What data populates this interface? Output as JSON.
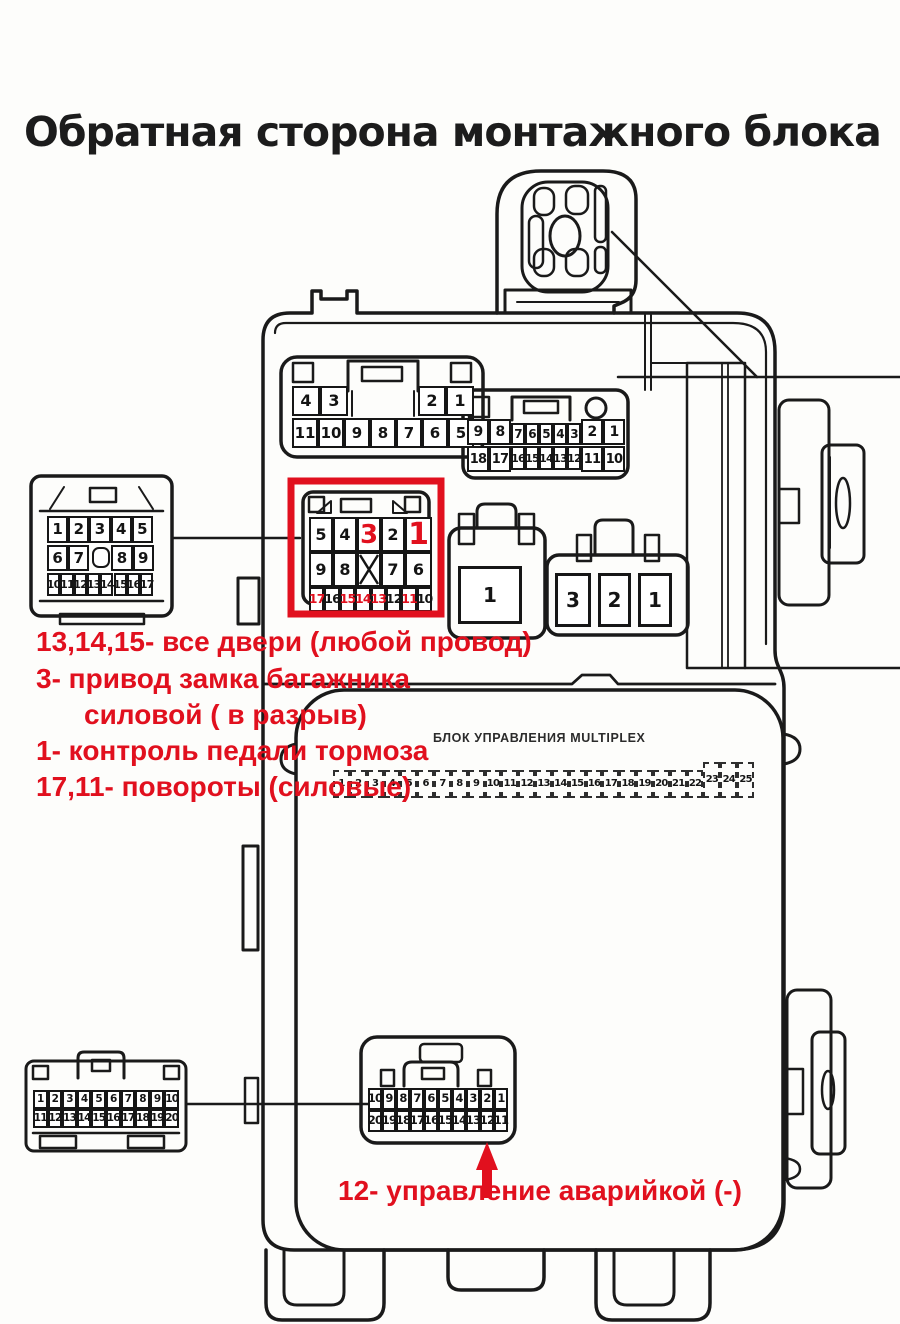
{
  "title": "Обратная сторона монтажного блока",
  "colors": {
    "red": "#e1101e",
    "ink": "#1a1a1a",
    "paper": "#fdfdfb"
  },
  "annotations": {
    "doors": "13,14,15- все двери (любой провод)",
    "trunk1": "3- привод замка багажника",
    "trunk2": "силовой ( в разрыв)",
    "brake": "1- контроль педали тормоза",
    "turn": "17,11- повороты (силовые)",
    "hazard": "12- управление аварийкой (-)"
  },
  "multiplex_panel": {
    "label": "БЛОК УПРАВЛЕНИЯ MULTIPLEX",
    "strip": [
      "1",
      "2",
      "3",
      "4",
      "5",
      "6",
      "7",
      "8",
      "9",
      "10",
      "11",
      "12",
      "13",
      "14",
      "15",
      "16",
      "17",
      "18",
      "19",
      "20",
      "21",
      "22",
      "23",
      "24",
      "25"
    ]
  },
  "connectors": {
    "left17": {
      "row1": [
        "1",
        "2",
        "3",
        "4",
        "5"
      ],
      "row2": [
        "6",
        "7",
        "8",
        "9"
      ],
      "row3": [
        "10",
        "11",
        "12",
        "13",
        "14",
        "15",
        "16",
        "17"
      ]
    },
    "topA": {
      "row1": [
        "4",
        "3",
        "2",
        "1"
      ],
      "row2": [
        "11",
        "10",
        "9",
        "8",
        "7",
        "6",
        "5"
      ]
    },
    "topB": {
      "row1": [
        "9",
        "8",
        "7",
        "6",
        "5",
        "4",
        "3",
        "2",
        "1"
      ],
      "row2": [
        "18",
        "17",
        "16",
        "15",
        "14",
        "13",
        "12",
        "11",
        "10"
      ]
    },
    "highlight": {
      "row1": [
        "5",
        "4",
        "3",
        "2",
        "1"
      ],
      "row1_red": [
        "3",
        "1"
      ],
      "row2": [
        "9",
        "8",
        "X",
        "7",
        "6"
      ],
      "row3": [
        "17",
        "16",
        "15",
        "14",
        "13",
        "12",
        "11",
        "10"
      ],
      "row3_red": [
        "17",
        "15",
        "14",
        "13",
        "11"
      ]
    },
    "single1": [
      "1"
    ],
    "triple": [
      "3",
      "2",
      "1"
    ],
    "botLeft": {
      "row1": [
        "1",
        "2",
        "3",
        "4",
        "5",
        "6",
        "7",
        "8",
        "9",
        "10"
      ],
      "row2": [
        "11",
        "12",
        "13",
        "14",
        "15",
        "16",
        "17",
        "18",
        "19",
        "20"
      ]
    },
    "botCenter": {
      "row1": [
        "10",
        "9",
        "8",
        "7",
        "6",
        "5",
        "4",
        "3",
        "2",
        "1"
      ],
      "row2": [
        "20",
        "19",
        "18",
        "17",
        "16",
        "15",
        "14",
        "13",
        "12",
        "11"
      ]
    }
  }
}
